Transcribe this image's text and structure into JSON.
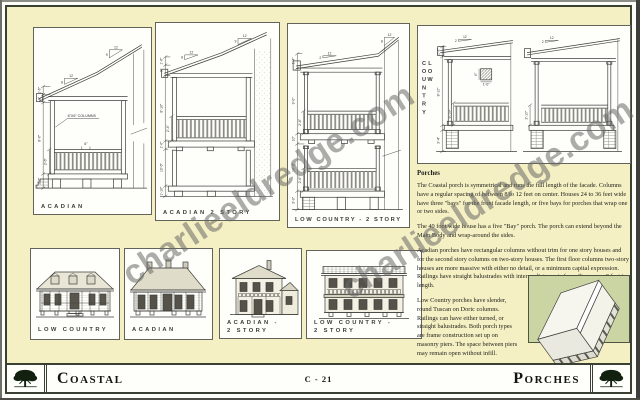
{
  "page": {
    "watermark_text": "charlieeldredge.com"
  },
  "footer": {
    "left_title": "Coastal",
    "page_number": "C - 21",
    "right_title": "Porches"
  },
  "sections": {
    "acadian": {
      "label": "ACADIAN",
      "column_note": "6\"X6\" COLUMNS",
      "rail_spacing": "6\"",
      "slope_low": {
        "run": "12",
        "rise": "8"
      },
      "slope_main": {
        "run": "12",
        "rise": "9"
      },
      "dims": [
        "1'-6\"",
        "8\"",
        "8'-6\"",
        "2'-6\"",
        "2'-6\""
      ]
    },
    "acadian_two_story": {
      "label": "ACADIAN 2 STORY",
      "slope_low": {
        "run": "12",
        "rise": "8"
      },
      "slope_main": {
        "run": "12",
        "rise": "9"
      },
      "dims": [
        "1'-6\"",
        "9\"",
        "8'-10\"",
        "2'-4\"",
        "1'-0\"",
        "10'-6\"",
        "1'-10\""
      ]
    },
    "low_country_two_story": {
      "label": "LOW COUNTRY - 2 STORY",
      "slope_low": {
        "run": "12",
        "rise": "2"
      },
      "slope_main": {
        "run": "12",
        "rise": "8"
      },
      "dims": [
        "1'-4\"",
        "9'-0\"",
        "2'-6\"",
        "10\"",
        "10'-0\"",
        "2'-6\"",
        "3'-0\""
      ]
    },
    "low_country": {
      "vertical_label": "LOW COUNTRY",
      "slope_left": {
        "run": "12",
        "rise": "2"
      },
      "slope_right": {
        "run": "12",
        "rise": "2"
      },
      "column_detail": {
        "side": "6\"",
        "base": "1'-0\""
      },
      "dims_left": [
        "1'-2\"",
        "8'-10\"",
        "2'-10\"",
        "3'-4\""
      ],
      "dims_right": [
        "2'-10\""
      ]
    }
  },
  "elevations": [
    {
      "line1": "LOW COUNTRY",
      "line2": ""
    },
    {
      "line1": "ACADIAN",
      "line2": ""
    },
    {
      "line1": "ACADIAN -",
      "line2": "2 STORY"
    },
    {
      "line1": "LOW COUNTRY -",
      "line2": "2 STORY"
    }
  ],
  "article": {
    "heading": "Porches",
    "paragraphs": [
      "The Coastal porch is symmetrical and runs the full length of the facade. Columns have a regular spacing of between 8 to 12 feet on center. Houses 24 to 36 feet wide have three \"bays\" for the front facade length, or five bays for porches that wrap one or two sides.",
      "The 40 foot wide house has a five \"Bay\" porch. The porch can extend beyond the Main Body and wrap-around the sides.",
      "Acadian porches have rectangular columns without trim for one story houses and for the second story columns on two-story houses. The first floor columns two-story houses are more massive with either no detail, or a minimum capital expression. Railings have straight balustrades with intermediate posts for railings over 9 feet in length.",
      "Low Country porches have slender, round Tuscan on Doric columns. Railings can have either turned, or straight balustrades. Both porch types are frame construction set up on masonry piers. The space between piers may remain open without infill."
    ]
  },
  "colors": {
    "page_background": "#f5f0c3",
    "frame": "#3a4132",
    "illustration_background": "#cbd5a4",
    "watermark": "#686866"
  }
}
